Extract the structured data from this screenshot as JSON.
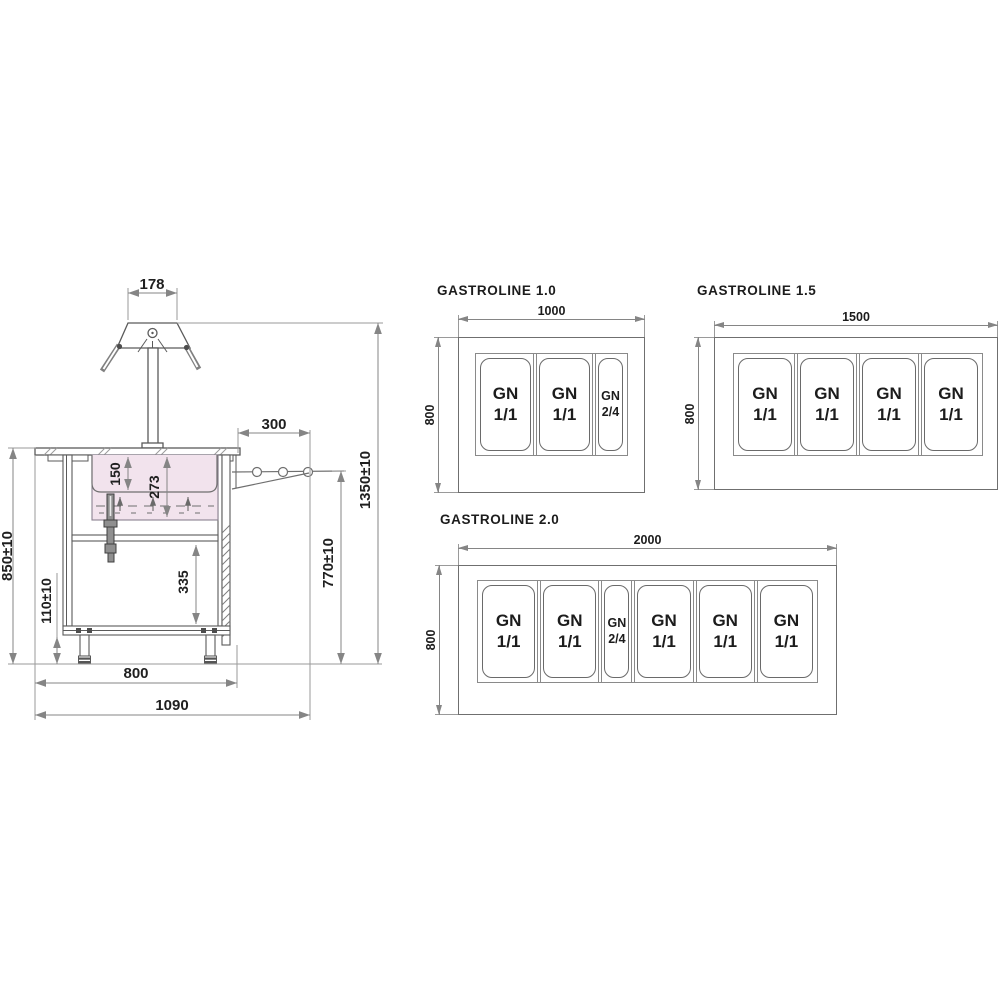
{
  "drawing": {
    "colors": {
      "well_fill": "#f2e3ed",
      "object_line": "#5a5a5a",
      "dim_line": "#858585",
      "text": "#1f1f1f"
    }
  },
  "side_view": {
    "lamp_width": "178",
    "tray_slide_depth": "300",
    "pan_depth": "150",
    "well_depth": "273",
    "shelf_clearance": "335",
    "worktop_height": "850±10",
    "plinth_height": "110±10",
    "tray_slide_height": "770±10",
    "overall_height": "1350±10",
    "body_width": "800",
    "overall_width": "1090"
  },
  "layouts": [
    {
      "title": "GASTROLINE 1.0",
      "width_label": "1000",
      "depth_label": "800",
      "pans": [
        {
          "name": "GN",
          "size": "1/1",
          "type": "wide"
        },
        {
          "name": "GN",
          "size": "1/1",
          "type": "wide"
        },
        {
          "name": "GN",
          "size": "2/4",
          "type": "narrow"
        }
      ]
    },
    {
      "title": "GASTROLINE 1.5",
      "width_label": "1500",
      "depth_label": "800",
      "pans": [
        {
          "name": "GN",
          "size": "1/1",
          "type": "wide"
        },
        {
          "name": "GN",
          "size": "1/1",
          "type": "wide"
        },
        {
          "name": "GN",
          "size": "1/1",
          "type": "wide"
        },
        {
          "name": "GN",
          "size": "1/1",
          "type": "wide"
        }
      ]
    },
    {
      "title": "GASTROLINE 2.0",
      "width_label": "2000",
      "depth_label": "800",
      "pans": [
        {
          "name": "GN",
          "size": "1/1",
          "type": "wide"
        },
        {
          "name": "GN",
          "size": "1/1",
          "type": "wide"
        },
        {
          "name": "GN",
          "size": "2/4",
          "type": "narrow"
        },
        {
          "name": "GN",
          "size": "1/1",
          "type": "wide"
        },
        {
          "name": "GN",
          "size": "1/1",
          "type": "wide"
        },
        {
          "name": "GN",
          "size": "1/1",
          "type": "wide"
        }
      ]
    }
  ]
}
